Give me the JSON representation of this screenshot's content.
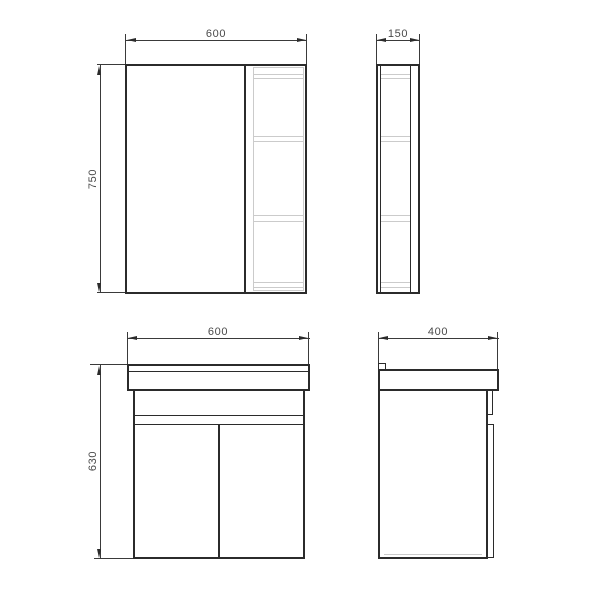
{
  "drawing": {
    "colors": {
      "line": "#2b2b2b",
      "secondary_line": "#cbcbcb",
      "text": "#4a4a4a",
      "background": "#ffffff"
    },
    "views": {
      "mirror_cabinet_front": {
        "width": "600",
        "height": "750"
      },
      "mirror_cabinet_side": {
        "depth": "150"
      },
      "vanity_front": {
        "width": "600",
        "height": "630"
      },
      "vanity_side": {
        "depth": "400"
      }
    }
  }
}
